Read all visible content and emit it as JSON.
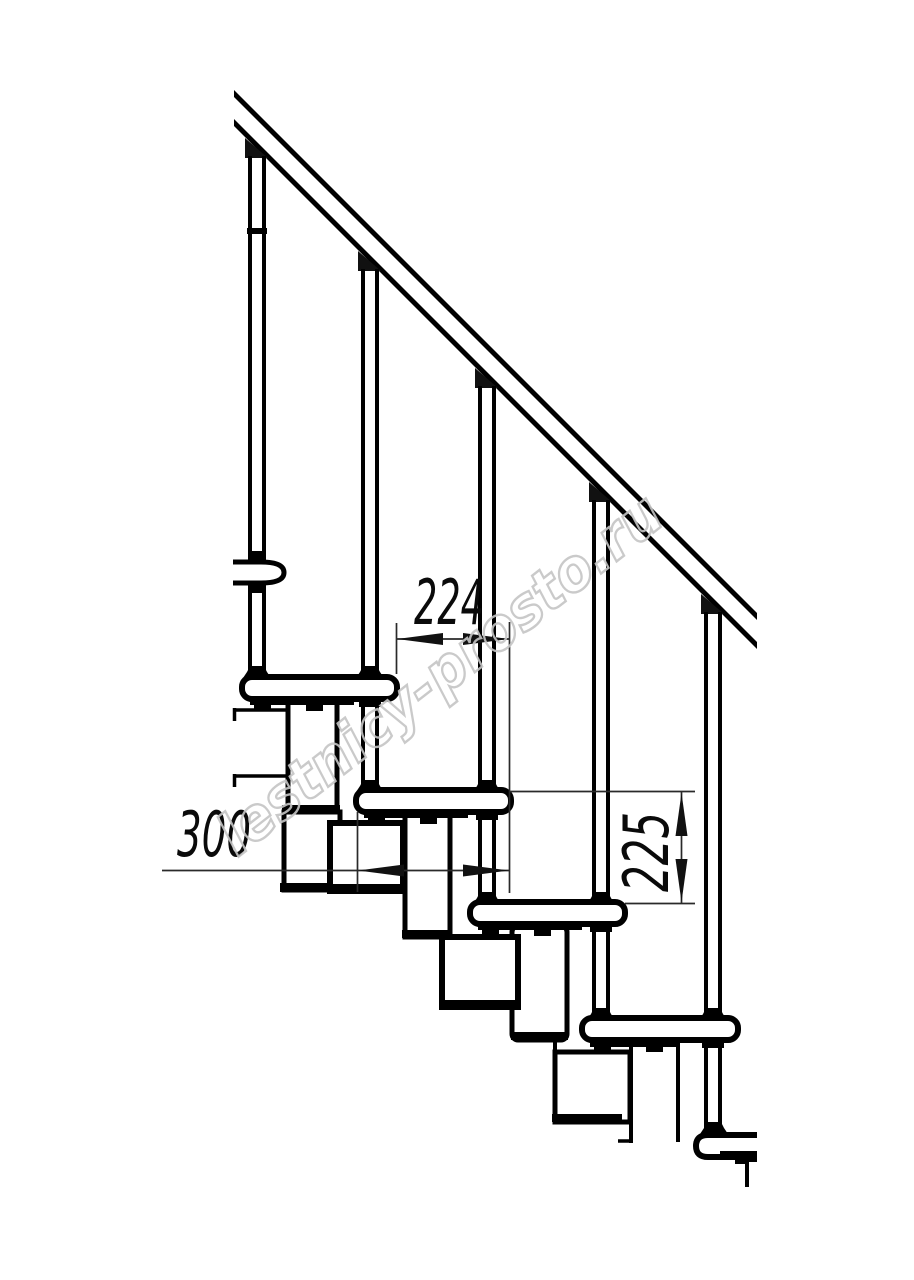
{
  "drawing": {
    "title": "modular-staircase-side-view",
    "watermark": "lestnicy-prosto.ru",
    "dimensions": {
      "step_run": {
        "value": "224"
      },
      "tread_depth": {
        "value": "300"
      },
      "step_rise": {
        "value": "225"
      }
    },
    "colors": {
      "line": "#000000",
      "dimension": "#2a2a2a",
      "watermark": "#c5c5c5",
      "background": "#ffffff"
    }
  }
}
